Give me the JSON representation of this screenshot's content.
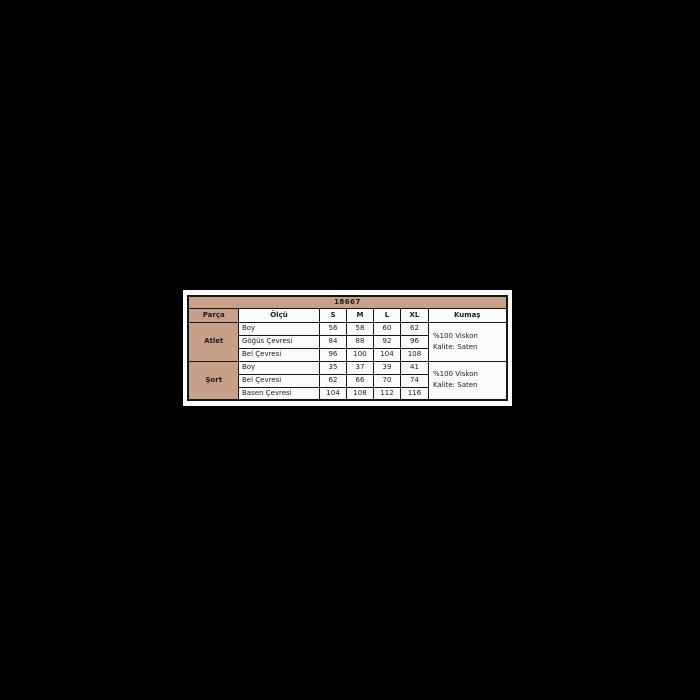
{
  "colors": {
    "background": "#000000",
    "panel": "#fbfbfa",
    "accent_tan": "#c7a087",
    "border": "#161616",
    "text": "#1c1c1c"
  },
  "chart_data": {
    "type": "table",
    "title": "18667",
    "columns": [
      "Parça",
      "Ölçü",
      "S",
      "M",
      "L",
      "XL",
      "Kumaş"
    ],
    "groups": [
      {
        "part": "Atlet",
        "measurements": [
          {
            "label": "Boy",
            "values": [
              56,
              58,
              60,
              62
            ]
          },
          {
            "label": "Göğüs Çevresi",
            "values": [
              84,
              88,
              92,
              96
            ]
          },
          {
            "label": "Bel Çevresi",
            "values": [
              96,
              100,
              104,
              108
            ]
          }
        ],
        "fabric_lines": [
          "%100 Viskon",
          "Kalite: Saten"
        ]
      },
      {
        "part": "Şort",
        "measurements": [
          {
            "label": "Boy",
            "values": [
              35,
              37,
              39,
              41
            ]
          },
          {
            "label": "Bel Çevresi",
            "values": [
              62,
              66,
              70,
              74
            ]
          },
          {
            "label": "Basen Çevresi",
            "values": [
              104,
              108,
              112,
              116
            ]
          }
        ],
        "fabric_lines": [
          "%100 Viskon",
          "Kalite: Saten"
        ]
      }
    ]
  }
}
